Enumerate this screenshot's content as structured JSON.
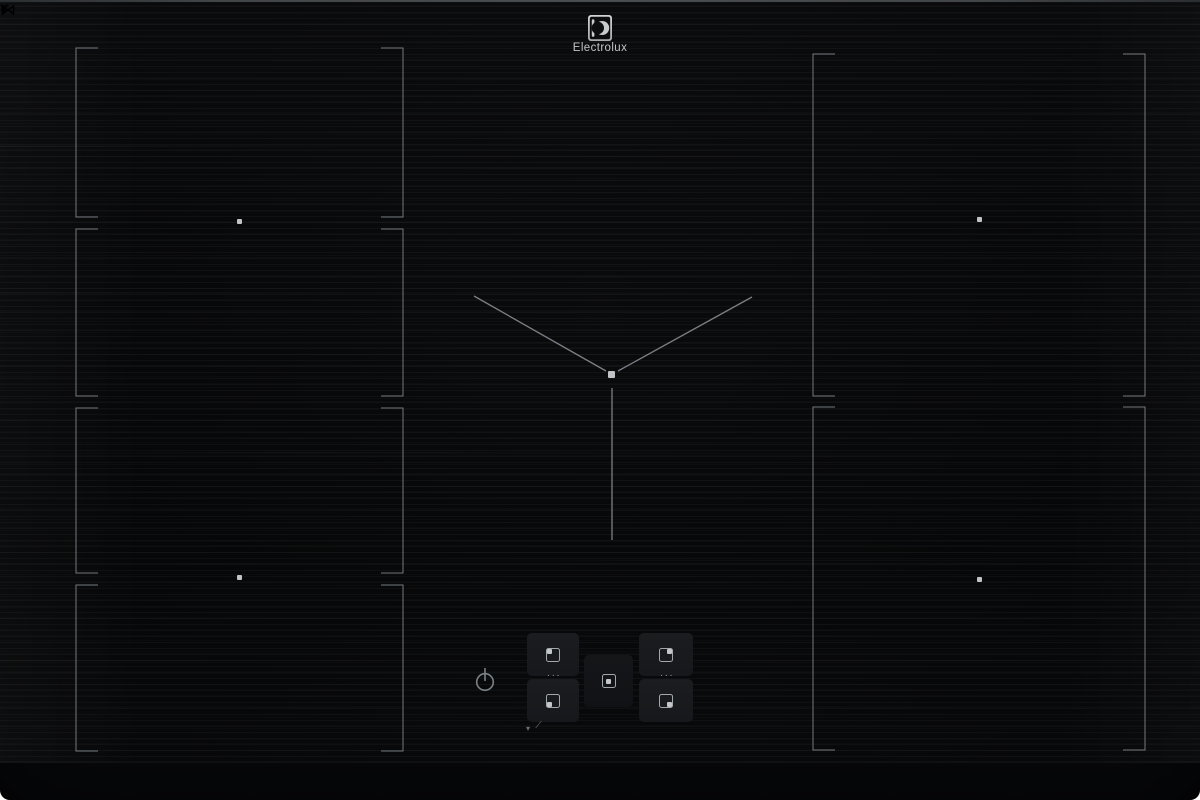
{
  "brand": {
    "logo_text": "Electrolux",
    "logo_symbol_icon": "electrolux-e-icon"
  },
  "surface": {
    "model_label": "SENSE PRO",
    "marking_color": "#7d8388",
    "dot_color": "#c0c4c6",
    "zones": {
      "left_flex_segments": 4,
      "right_flex_segments": 2,
      "center_guide": "y-marking"
    }
  },
  "controls": {
    "power_icon": "power-icon",
    "ellipsis": "···",
    "zone_selectors": [
      {
        "id": "left-rear",
        "dot_position": "top-left"
      },
      {
        "id": "left-front",
        "dot_position": "bottom-left"
      },
      {
        "id": "center",
        "dot_position": "center"
      },
      {
        "id": "right-rear",
        "dot_position": "top-right"
      },
      {
        "id": "right-front",
        "dot_position": "bottom-right"
      }
    ],
    "aux_left": [
      {
        "name": "triangle-down-icon",
        "glyph": "▾"
      },
      {
        "name": "slider-pen-icon",
        "glyph": "∕"
      }
    ],
    "aux_center": [
      {
        "name": "bridge-icon",
        "glyph": "="
      },
      {
        "name": "bowtie-icon",
        "glyph": "⋈"
      },
      {
        "name": "hood-icon",
        "glyph": "ʏ"
      }
    ]
  }
}
